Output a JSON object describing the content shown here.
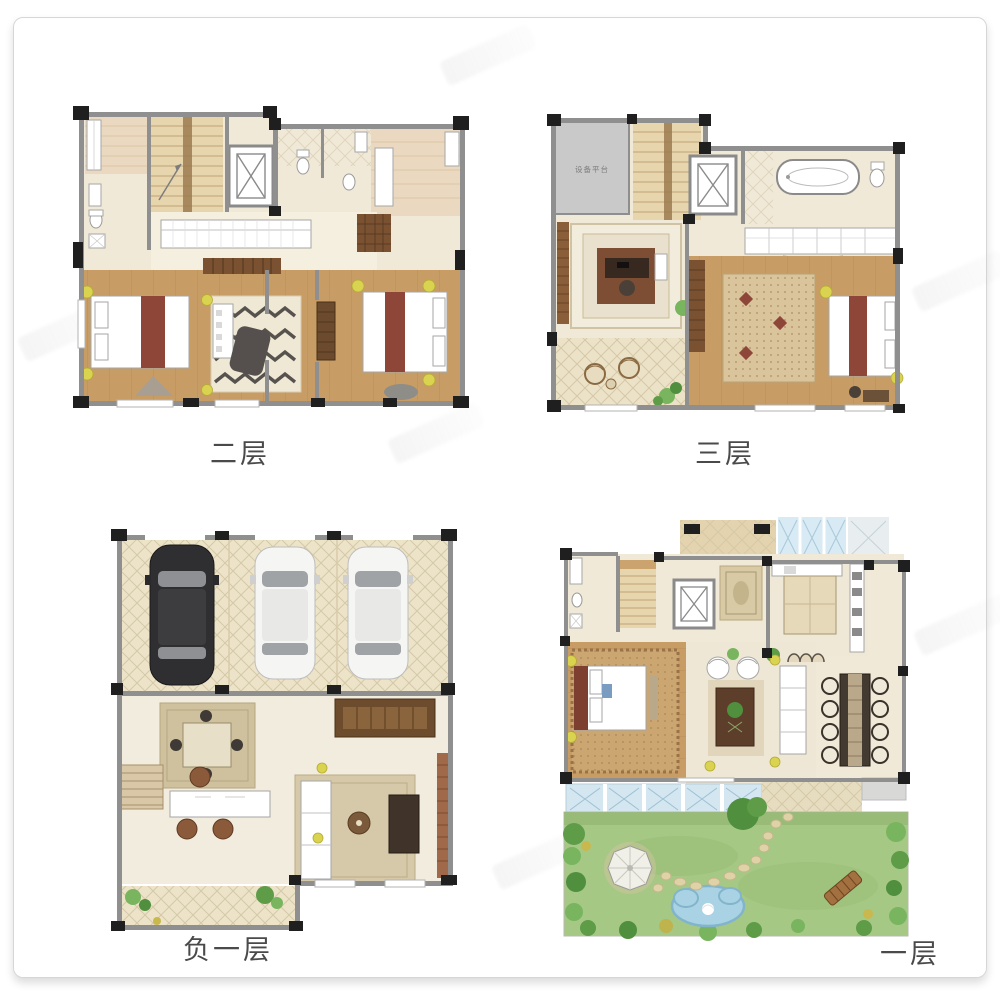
{
  "document": {
    "type": "real-estate floor plan sheet",
    "background": "#ffffff",
    "frame_border_color": "#d6d6d6"
  },
  "floors": [
    {
      "id": "second-floor",
      "label": "二层",
      "position": "top-left",
      "features": [
        "three bedrooms",
        "two bathrooms",
        "staircase",
        "elevator",
        "long wardrobe corridor"
      ]
    },
    {
      "id": "third-floor",
      "label": "三层",
      "position": "top-right",
      "platform_label": "设备平台",
      "features": [
        "equipment platform",
        "study with rug",
        "balcony with chairs",
        "master bedroom",
        "bathtub bathroom",
        "closet row",
        "staircase",
        "elevator"
      ]
    },
    {
      "id": "basement-floor",
      "label": "负一层",
      "position": "bottom-left",
      "features": [
        "garage with 3 cars (1 black, 2 white)",
        "game table",
        "desk",
        "sofa and TV lounge",
        "patio with plants"
      ]
    },
    {
      "id": "first-floor",
      "label": "一层",
      "position": "bottom-right",
      "features": [
        "entry porch",
        "kitchen",
        "bedroom",
        "living room",
        "dining table with 8 chairs",
        "glass canopy",
        "garden with lawn, gazebo, pond, stepping stones, bench",
        "staircase",
        "elevator"
      ]
    }
  ],
  "palette": {
    "wall_gray": "#8f8f8f",
    "wall_black": "#1f1f1f",
    "floor_cream": "#f0e9d8",
    "floor_tan": "#ead9c0",
    "wood_floor": "#c79d65",
    "bed_accent_maroon": "#8d4638",
    "lamp_yellow": "#d9d34f",
    "rug_beige": "#d9c49c",
    "cabinet_brown": "#7a5232",
    "platform_gray": "#c9c9c9",
    "car_black": "#2f2f31",
    "car_white": "#f5f5f3",
    "glass_blue": "#d8eaf3",
    "lawn_green": "#a6c885",
    "tree_green": "#5e9c48",
    "pond_blue": "#a9d3e4",
    "stone_tan": "#ded2a6",
    "caption_text": "#4a4a4a"
  }
}
